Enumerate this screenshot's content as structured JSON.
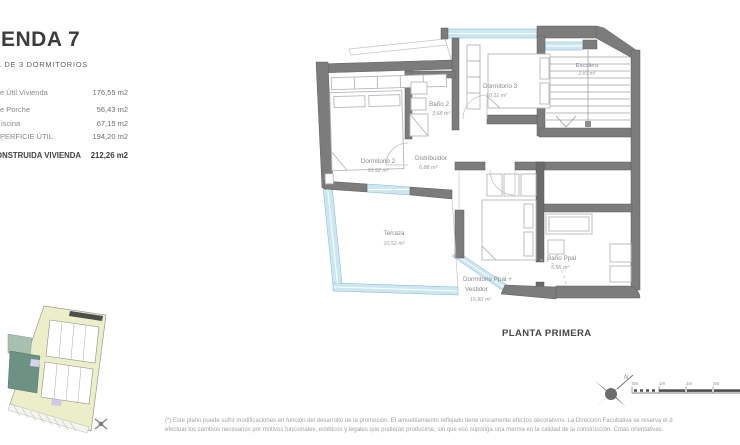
{
  "header": {
    "title": "ENDA 7",
    "subtitle": "L DE 3 DORMITORIOS"
  },
  "summary": {
    "rows": [
      {
        "label": "e Útil Vivienda",
        "value": "176,55 m2"
      },
      {
        "label": "e Porche",
        "value": "56,43 m2"
      },
      {
        "label": "iscina",
        "value": "67,15 m2"
      },
      {
        "label": "PERFICIE ÚTIL",
        "value": "194,20 m2"
      },
      {
        "label": "ONSTRUIDA VIVIENDA",
        "value": "212,26 m2"
      }
    ],
    "footnote_mark": "*"
  },
  "plan": {
    "floor_label": "PLANTA PRIMERA",
    "rooms": {
      "dormitorio2": {
        "name": "Dormitorio 2",
        "area": "10,92 m²"
      },
      "bano2": {
        "name": "Baño 2",
        "area": "3,68 m²"
      },
      "distribuidor": {
        "name": "Distribuidor",
        "area": "6,88 m²"
      },
      "dormitorio3": {
        "name": "Dormitorio 3",
        "area": "10,11 m²"
      },
      "escalera": {
        "name": "Escalera",
        "area": "2,81 m²"
      },
      "terraza": {
        "name": "Terraza",
        "area": "10,52 m²"
      },
      "dormitorio_ppal": {
        "name_line1": "Dormitorio Ppal +",
        "name_line2": "Vestidor",
        "area": "16,82 m²"
      },
      "bano_ppal": {
        "name": "Baño Ppal",
        "area": "5,55 m²"
      }
    },
    "compass": {
      "north_label": "N"
    },
    "scale_bar": {
      "ticks": [
        "0m",
        "1m",
        "2m",
        "3m"
      ]
    }
  },
  "footer": {
    "line1": "(*) Este plano puede sufrir modificaciones en función del desarrollo de la promoción. El amueblamiento reflejado tiene únicamente efectos decorativos. La Dirección Facultativa se reserva el d",
    "line2": "efectuar los cambios necesarios por motivos funcionales, estéticos y legales que pudieran producirse, sin que eso suponga una merma en la calidad de la construcción. Cotas orientativas."
  },
  "colors": {
    "wall": "#7c7c7c",
    "window": "#cde7f2",
    "highlight_green": "#6d9182",
    "site_olive": "#eceec9",
    "lavender": "#d8d2ea"
  }
}
